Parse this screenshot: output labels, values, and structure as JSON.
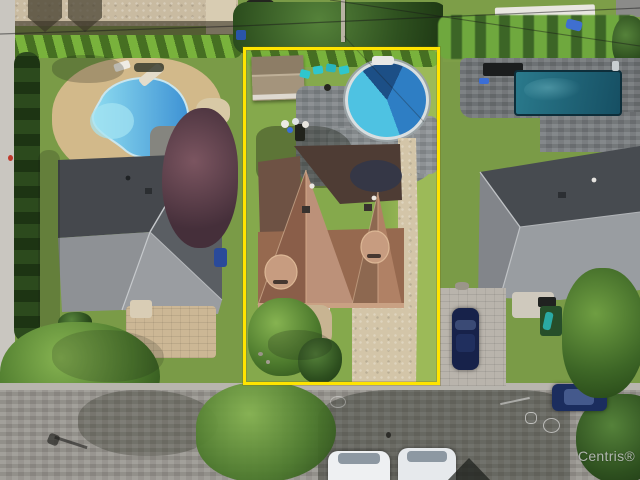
{
  "watermark": {
    "text": "Centris®"
  },
  "property_outline": {
    "shape": "rectangle",
    "purpose": "listing-lot-boundary"
  },
  "colors": {
    "outline": "#ffe400",
    "watermark": "#c6c6c8",
    "lawn": "#7a9b47",
    "lawn_bright": "#9cba58",
    "hedge_dark": "#24421c",
    "street": "#96938d",
    "curb": "#b8b5ae",
    "gravel_yard": "#c9bba1",
    "deck_tan": "#d2b98a",
    "driveway_tan": "#ccb795",
    "driveway_gravel": "#d3c5a8",
    "paver_gray": "#b9b4ac",
    "patio_gray": "#7e8386",
    "roof_gray_dark": "#45484d",
    "roof_gray_light": "#9a9da1",
    "roof_brown_light": "#bc9179",
    "roof_brown_dark": "#8a5e49",
    "roof_top_dark": "#4e3c34",
    "pool_round_blue": "#2e7ec4",
    "pool_round_light": "#4ec2e2",
    "pool_round_dark": "#1c4f86",
    "pool_kidney_light": "#8edcf0",
    "pool_kidney_blue": "#3e92d4",
    "pool_rect_teal_a": "#2a7a8c",
    "pool_rect_teal_b": "#164f63",
    "teal_furniture": "#2fc6cd",
    "tree_purple_a": "#7b5560",
    "tree_purple_b": "#452f3a",
    "car_navy": "#1b2d5e",
    "car_white": "#eef0f2"
  }
}
